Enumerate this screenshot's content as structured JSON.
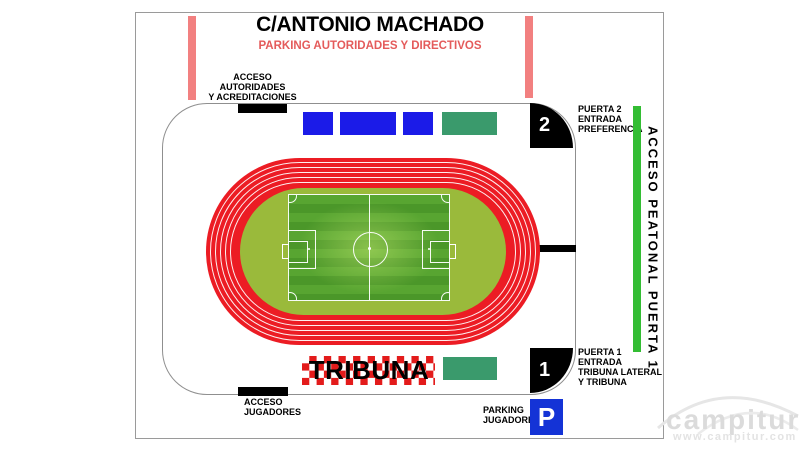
{
  "header": {
    "street_name": "C/ANTONIO MACHADO",
    "parking_label": "PARKING AUTORIDADES Y DIRECTIVOS"
  },
  "stadium": {
    "access_autoridades": "ACCESO\nAUTORIDADES\nY ACREDITACIONES",
    "access_jugadores": "ACCESO\nJUGADORES",
    "tribuna_label": "TRIBUNA"
  },
  "gates": {
    "gate2_number": "2",
    "gate2_label": "PUERTA 2\nENTRADA\nPREFERENCIA",
    "gate1_number": "1",
    "gate1_label": "PUERTA 1\nENTRADA\nTRIBUNA LATERAL\nY TRIBUNA",
    "pedestrian_access": "ACCESO PEATONAL PUERTA 1"
  },
  "parking": {
    "players_label": "PARKING\nJUGADORES",
    "sign": "P"
  },
  "watermark": {
    "name": "campitur",
    "url": "www.campitur.com"
  },
  "colors": {
    "track_red": "#ec1c24",
    "infield_green": "#9aba3b",
    "pitch_green": "#52a02d",
    "seat_blue": "#1b1be8",
    "seat_teal": "#3a9a6c",
    "pink_bar": "#f28080",
    "access_green": "#33bd33",
    "checker_red": "#e31b1b",
    "gate_black": "#000000",
    "parking_blue": "#1433d6",
    "subtitle_red": "#e45b5b"
  }
}
